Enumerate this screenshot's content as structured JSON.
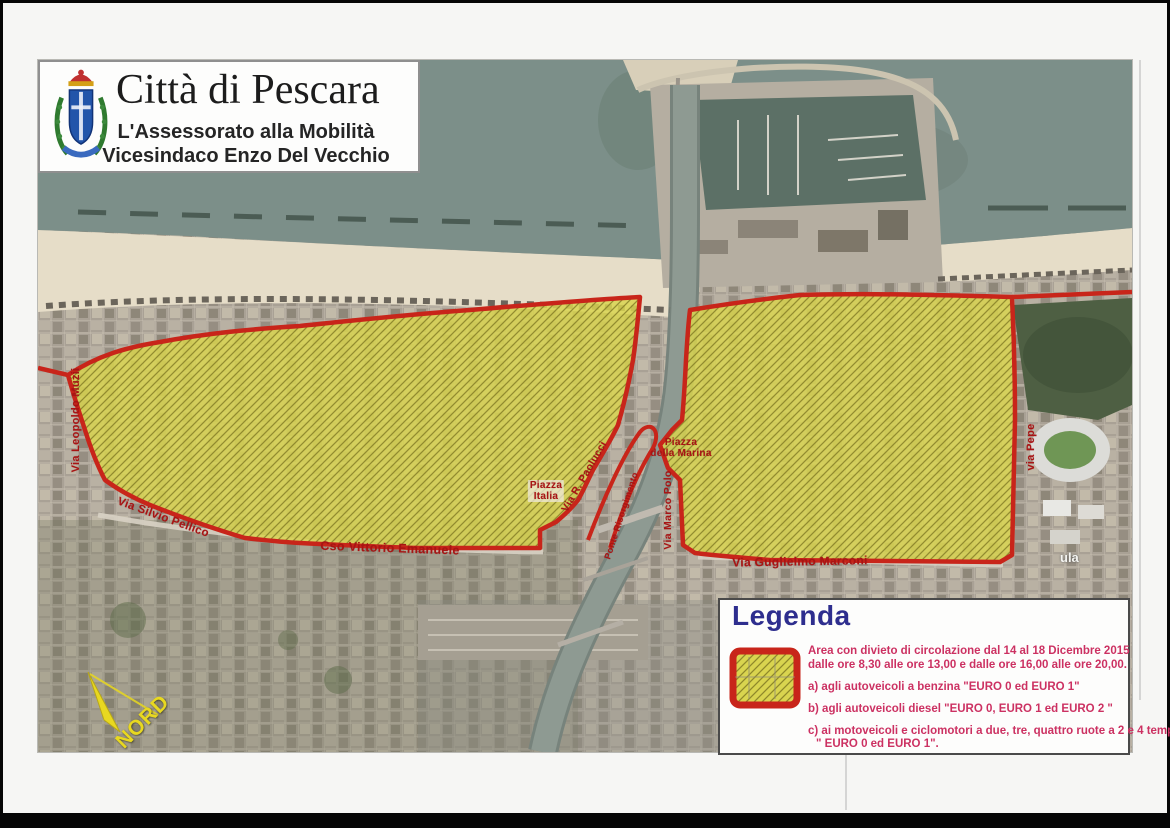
{
  "header": {
    "title": "Città di Pescara",
    "subtitle_line1": "L'Assessorato alla Mobilità",
    "subtitle_line2": "Vicesindaco Enzo Del Vecchio"
  },
  "map": {
    "north_label": "NORD",
    "partial_label": "ula",
    "street_labels": [
      {
        "id": "via-leopoldo-muzii",
        "text": "Via Leopoldo Muzii"
      },
      {
        "id": "via-silvio-pellico",
        "text": "Via Silvio Pellico"
      },
      {
        "id": "cso-vittorio-emanuele",
        "text": "Cso Vittorio Emanuele"
      },
      {
        "id": "piazza-italia",
        "text": "Piazza\nItalia"
      },
      {
        "id": "via-r-paolucci",
        "text": "Via R. Paolucci"
      },
      {
        "id": "ponte-risorgimento",
        "text": "Ponte Risorgimento"
      },
      {
        "id": "piazza-della-marina",
        "text": "Piazza\ndella Marina"
      },
      {
        "id": "via-marco-polo",
        "text": "Via Marco Polo"
      },
      {
        "id": "via-guglielmo-marconi",
        "text": "Via Guglielmo Marconi"
      },
      {
        "id": "via-pepe",
        "text": "via Pepe"
      }
    ]
  },
  "legend": {
    "title": "Legenda",
    "description_line1": "Area con divieto di circolazione dal 14 al 18 Dicembre 2015",
    "description_line2": "dalle ore 8,30 alle ore 13,00 e dalle ore 16,00 alle ore 20,00.",
    "item_a": "a) agli autoveicoli a benzina \"EURO 0 ed EURO 1\"",
    "item_b": "b) agli autoveicoli diesel \"EURO 0, EURO 1 ed EURO 2 \"",
    "item_c_line1": "c) ai motoveicoli e ciclomotori a due, tre, quattro ruote a 2 e 4 tempi",
    "item_c_line2": "\" EURO 0 ed EURO 1\"."
  },
  "colors": {
    "restricted_zone_fill": "#d9d44f",
    "restricted_zone_hatch": "#7c7520",
    "zone_border": "#c8251a",
    "street_label": "#a81414",
    "legend_title": "#2e2e8e",
    "legend_text": "#cc3162",
    "sea": "#7c8f89",
    "beach": "#e6ddc8",
    "city": "#a9a195",
    "north_arrow": "#e8d820"
  }
}
